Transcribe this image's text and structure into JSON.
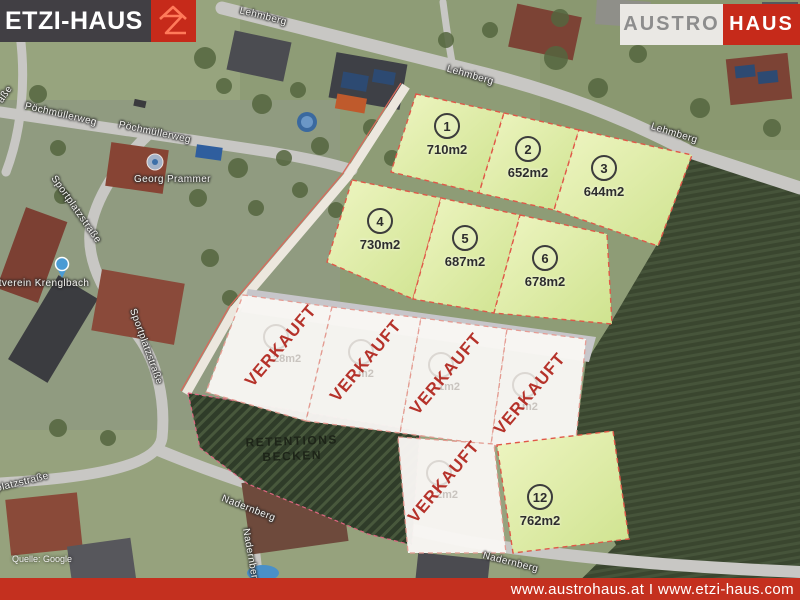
{
  "header": {
    "etzi_logo": {
      "text": "ETZI-HAUS",
      "icon": "etzi-z-house-icon",
      "bar_color": "#413f44",
      "accent": "#c62a1a"
    },
    "austro_logo": {
      "text_gray": "AUSTRO",
      "text_red": "HAUS",
      "bg": "#eae8e4",
      "accent": "#c62a1a"
    }
  },
  "footer": {
    "urls": "www.austrohaus.at I www.etzi-haus.com",
    "bg_color": "#c4301f"
  },
  "map": {
    "attribution": "Quelle: Google",
    "streets": {
      "lehmberg": "Lehmberg",
      "poechmuellerweg": "Pöchmüllerweg",
      "sportplatzstrasse": "Sportplatzstraße",
      "nadernberg": "Nadernberg",
      "street_fragment": "aße"
    },
    "pois": {
      "prammer": "Georg Prammer",
      "verein": "Sportverein Krenglbach"
    }
  },
  "plots": {
    "available": [
      {
        "number": "1",
        "size": "710m2"
      },
      {
        "number": "2",
        "size": "652m2"
      },
      {
        "number": "3",
        "size": "644m2"
      },
      {
        "number": "4",
        "size": "730m2"
      },
      {
        "number": "5",
        "size": "687m2"
      },
      {
        "number": "6",
        "size": "678m2"
      },
      {
        "number": "12",
        "size": "762m2"
      }
    ],
    "sold_label": "VERKAUFT",
    "sold": [
      {
        "ghost_size": "28m2"
      },
      {
        "ghost_size": "m2"
      },
      {
        "ghost_size": "1m2"
      },
      {
        "ghost_size": "m2"
      },
      {
        "ghost_size": "2m2"
      }
    ],
    "retention_basin": {
      "line1": "RETENTIONS",
      "line2": "BECKEN"
    },
    "colors": {
      "available_fill": "#dcec9e",
      "sold_fill": "#f9f7f4",
      "border_dashed": "#e05848",
      "sold_text": "#b5322a"
    }
  }
}
